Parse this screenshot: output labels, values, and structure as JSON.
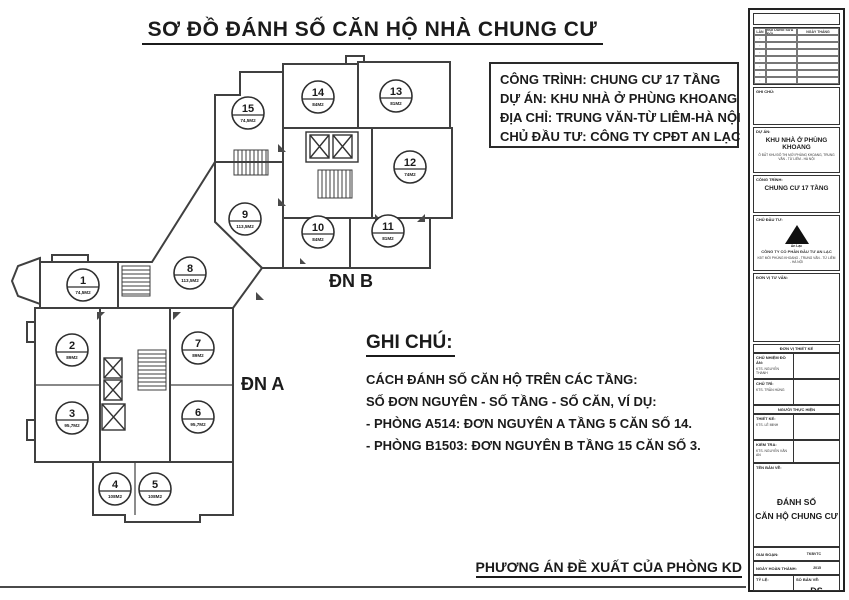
{
  "page": {
    "title": "SƠ ĐỒ ĐÁNH SỐ CĂN HỘ NHÀ CHUNG CƯ",
    "footer": "PHƯƠNG ÁN ĐỀ XUẤT CỦA PHÒNG KD"
  },
  "info_box": {
    "line1": "CÔNG TRÌNH: CHUNG CƯ 17 TẦNG",
    "line2": "DỰ ÁN: KHU NHÀ Ở PHÙNG KHOANG",
    "line3": "ĐỊA CHỈ: TRUNG VĂN-TỪ LIÊM-HÀ NỘI",
    "line4": "CHỦ ĐẦU TƯ: CÔNG TY CPĐT AN LẠC"
  },
  "notes": {
    "heading": "GHI CHÚ:",
    "line1": "CÁCH ĐÁNH SỐ CĂN HỘ TRÊN CÁC TẦNG:",
    "line2": "SỐ ĐƠN NGUYÊN - SỐ TẦNG - SỐ CĂN, VÍ DỤ:",
    "line3": "- PHÒNG A514: ĐƠN NGUYÊN A TẦNG 5 CĂN SỐ 14.",
    "line4": "- PHÒNG B1503: ĐƠN NGUYÊN B TẦNG 15 CĂN SỐ 3."
  },
  "plan": {
    "section_a_label": "ĐN A",
    "section_b_label": "ĐN B",
    "units": [
      {
        "no": "1",
        "area": "74,5M2",
        "x": 83,
        "y": 285
      },
      {
        "no": "2",
        "area": "89M2",
        "x": 72,
        "y": 350
      },
      {
        "no": "3",
        "area": "95,7M2",
        "x": 72,
        "y": 418
      },
      {
        "no": "4",
        "area": "108M2",
        "x": 115,
        "y": 489
      },
      {
        "no": "5",
        "area": "108M2",
        "x": 155,
        "y": 489
      },
      {
        "no": "6",
        "area": "95,7M2",
        "x": 198,
        "y": 417
      },
      {
        "no": "7",
        "area": "89M2",
        "x": 198,
        "y": 348
      },
      {
        "no": "8",
        "area": "113,5M2",
        "x": 190,
        "y": 273
      },
      {
        "no": "9",
        "area": "113,5M2",
        "x": 245,
        "y": 219
      },
      {
        "no": "10",
        "area": "84M2",
        "x": 318,
        "y": 232
      },
      {
        "no": "11",
        "area": "81M2",
        "x": 388,
        "y": 231
      },
      {
        "no": "12",
        "area": "74M2",
        "x": 410,
        "y": 167
      },
      {
        "no": "13",
        "area": "81M2",
        "x": 396,
        "y": 96
      },
      {
        "no": "14",
        "area": "84M2",
        "x": 318,
        "y": 97
      },
      {
        "no": "15",
        "area": "74,5M2",
        "x": 248,
        "y": 113
      }
    ]
  },
  "title_block": {
    "revision_table": {
      "col1": "LẦN",
      "col2": "NỘI DUNG SỬA ĐỔI",
      "col3": "NGÀY THÁNG"
    },
    "note_label": "GHI CHÚ:",
    "project": {
      "label": "DỰ ÁN:",
      "name": "KHU NHÀ Ở PHÙNG KHOANG",
      "sub": "Ô ĐẤT KHU ĐÔ THỊ MỚI PHÙNG KHOANG, TRUNG VĂN - TỪ LIÊM - HÀ NỘI"
    },
    "work": {
      "label": "CÔNG TRÌNH:",
      "name": "CHUNG CƯ 17 TẦNG"
    },
    "investor": {
      "label": "CHỦ ĐẦU TƯ:",
      "logo_caption": "An Lạc",
      "name": "CÔNG TY CỔ PHẦN ĐẦU TƯ AN LẠC",
      "sub": "KĐT MỚI PHÙNG KHOANG - TRUNG VĂN - TỪ LIÊM - HÀ NỘI"
    },
    "consultant_label": "ĐƠN VỊ TƯ VẤN:",
    "team": {
      "band1": "ĐƠN VỊ THIẾT KẾ",
      "rows1": [
        {
          "label": "CHỦ NHIỆM ĐỒ ÁN:",
          "name": "KTS. NGUYỄN THANH"
        },
        {
          "label": "CHỦ TRÌ:",
          "name": "KTS. TRẦN HÙNG"
        }
      ],
      "band2": "NGƯỜI THỰC HIỆN",
      "rows2": [
        {
          "label": "THIẾT KẾ:",
          "name": "KTS. LÊ MINH"
        },
        {
          "label": "KIỂM TRA:",
          "name": "KTS. NGUYỄN VĂN AN"
        }
      ]
    },
    "drawing": {
      "label": "TÊN BẢN VẼ:",
      "name1": "ĐÁNH SỐ",
      "name2": "CĂN HỘ CHUNG CƯ"
    },
    "meta_rows": [
      {
        "label": "GIAI ĐOẠN:",
        "value": "TKBVTC"
      },
      {
        "label": "NGÀY HOÀN THÀNH:",
        "value": "2015"
      }
    ],
    "scale": {
      "label": "TỶ LỆ:",
      "value": "-"
    },
    "number": {
      "label": "SỐ BẢN VẼ:",
      "value": "ĐS"
    }
  }
}
